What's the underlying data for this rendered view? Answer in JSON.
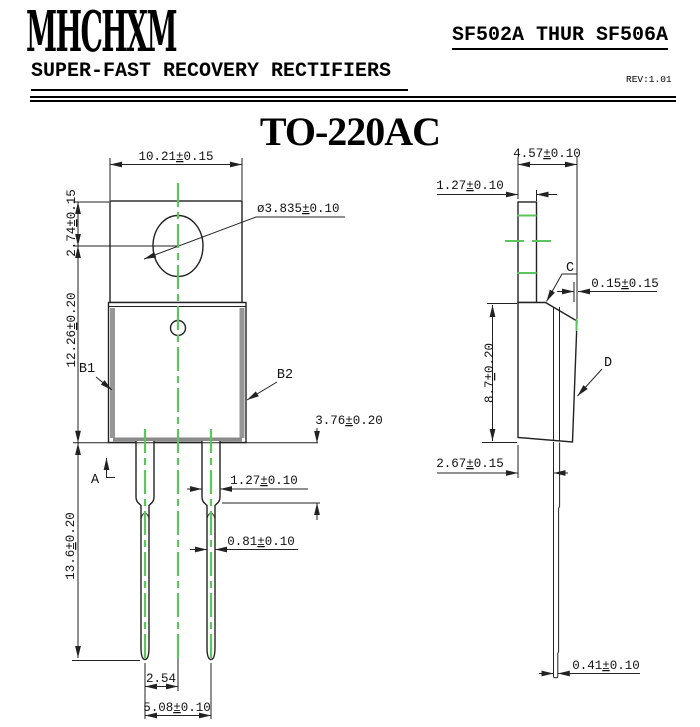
{
  "header": {
    "logo": "MHCHXM",
    "part_range": "SF502A THUR SF506A",
    "subtitle": "SUPER-FAST RECOVERY RECTIFIERS",
    "revision": "REV:1.01"
  },
  "title": "TO-220AC",
  "colors": {
    "centerline_green": "#5dc55d",
    "drawing_line": "#222222",
    "body_edge_gray": "#969696"
  },
  "front_view": {
    "dims": {
      "tab_width": "10.21±0.15",
      "hole_offset": "2.74±0.15",
      "hole_diameter": "ø3.835±0.10",
      "body_height": "12.26±0.20",
      "lead_length": "13.6±0.20",
      "shoulder_length": "3.76±0.20",
      "lead_width_wide": "1.27±0.10",
      "lead_width_narrow": "0.81±0.10",
      "pitch_half": "2.54",
      "pitch": "5.08±0.10"
    },
    "labels": {
      "section_a": "A",
      "b1": "B1",
      "b2": "B2"
    }
  },
  "side_view": {
    "dims": {
      "depth": "4.57±0.10",
      "tab_thickness": "1.27±0.10",
      "back_step": "0.15±0.15",
      "lower_height": "8.7±0.20",
      "lead_offset": "2.67±0.15",
      "tip_thickness": "0.41±0.10"
    },
    "labels": {
      "c": "C",
      "d": "D"
    }
  }
}
